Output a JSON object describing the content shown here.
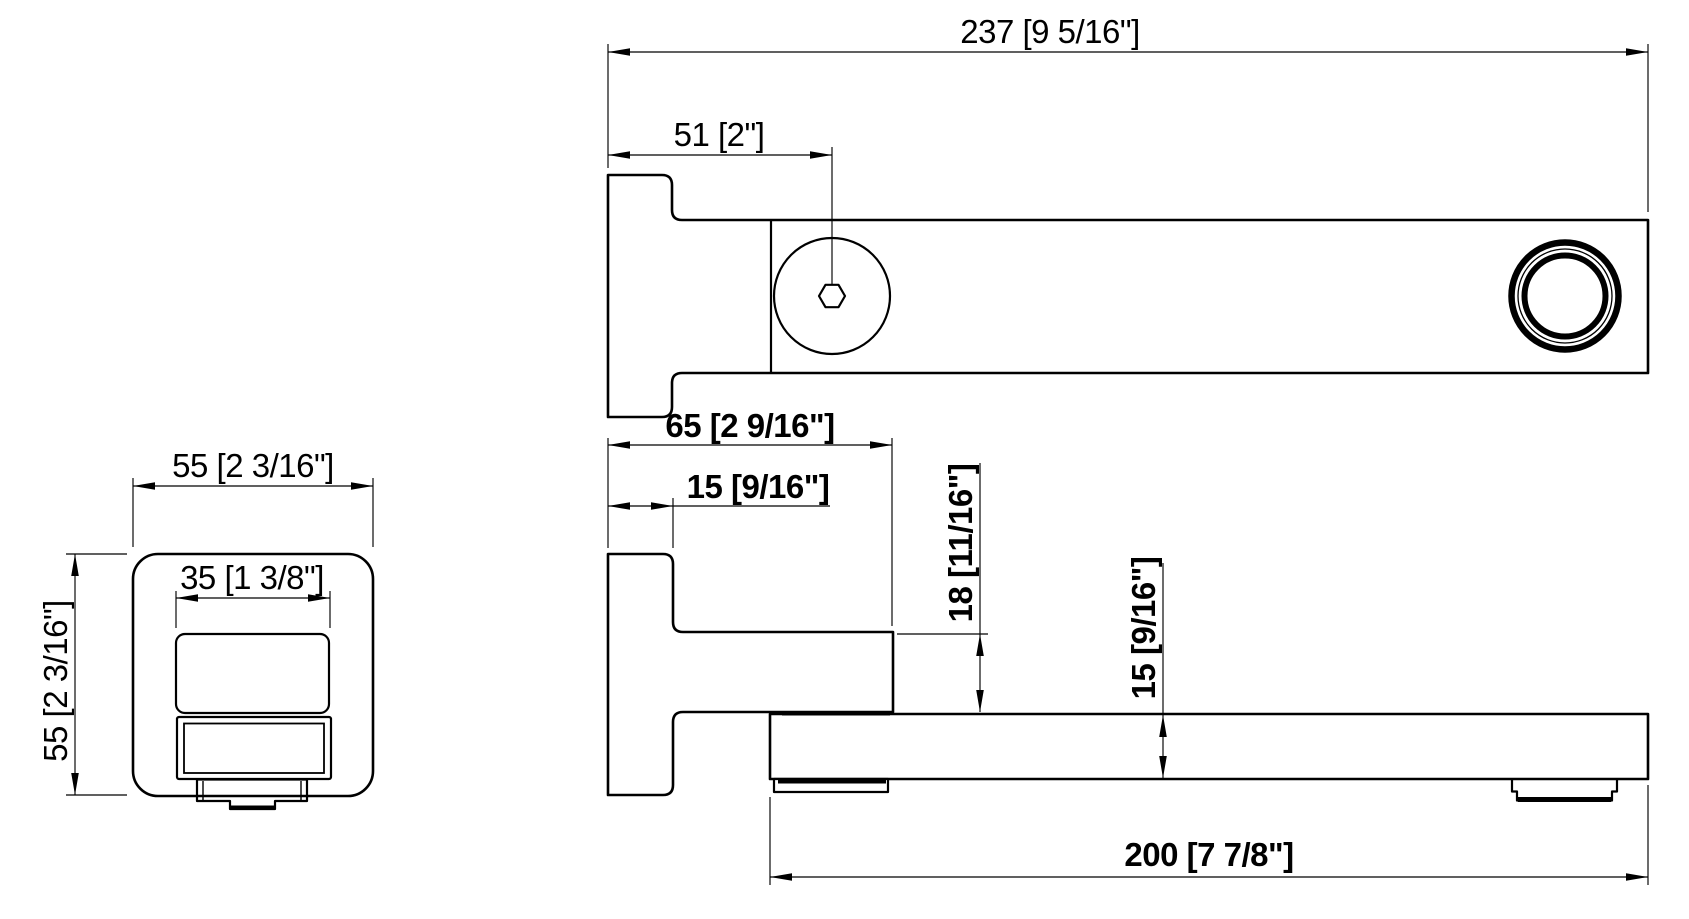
{
  "drawing": {
    "type": "technical-dimension-drawing",
    "background": "#ffffff",
    "line_color": "#000000",
    "views": {
      "front": {
        "label": "front-view",
        "dims": {
          "width": "55 [2 3/16\"]",
          "height": "55 [2 3/16\"]",
          "outlet_width": "35 [1 3/8\"]"
        }
      },
      "top": {
        "label": "top-view",
        "dims": {
          "overall_length": "237 [9 5/16\"]",
          "setscrew_offset": "51 [2\"]"
        }
      },
      "side": {
        "label": "side-view",
        "dims": {
          "projection": "65 [2 9/16\"]",
          "flange_thickness": "15 [9/16\"]",
          "body_height": "18 [11/16\"]",
          "spout_height": "15 [9/16\"]",
          "reach": "200 [7 7/8\"]"
        }
      }
    }
  }
}
